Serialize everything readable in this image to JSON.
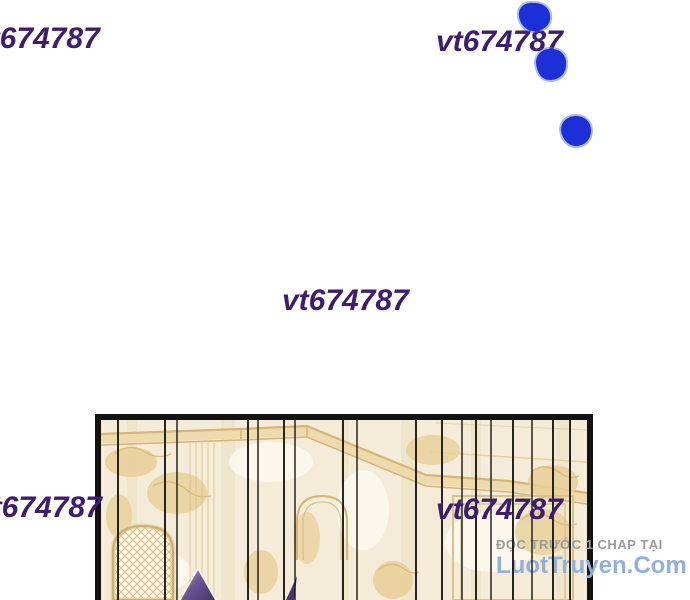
{
  "watermark": {
    "text": "vt674787",
    "color": "#3e1c6f",
    "instances": [
      "top-left",
      "top-right",
      "center",
      "bottom-left",
      "bottom-right"
    ]
  },
  "site_credit": {
    "line1": "ĐỌC TRƯỚC 1 CHAP TẠI",
    "line2": "LuotTruyen.Com",
    "line1_color": "#9b9b9b",
    "line2_color": "#92b0dd"
  },
  "ink_blots": {
    "count": 3,
    "color": "#1d2fd7"
  },
  "panel": {
    "background_color": "#f4ecd8",
    "gold_color": "#d6b577",
    "border_color": "#121212",
    "effect_line_color": "#17150f",
    "hair_color": "#4a3570"
  }
}
